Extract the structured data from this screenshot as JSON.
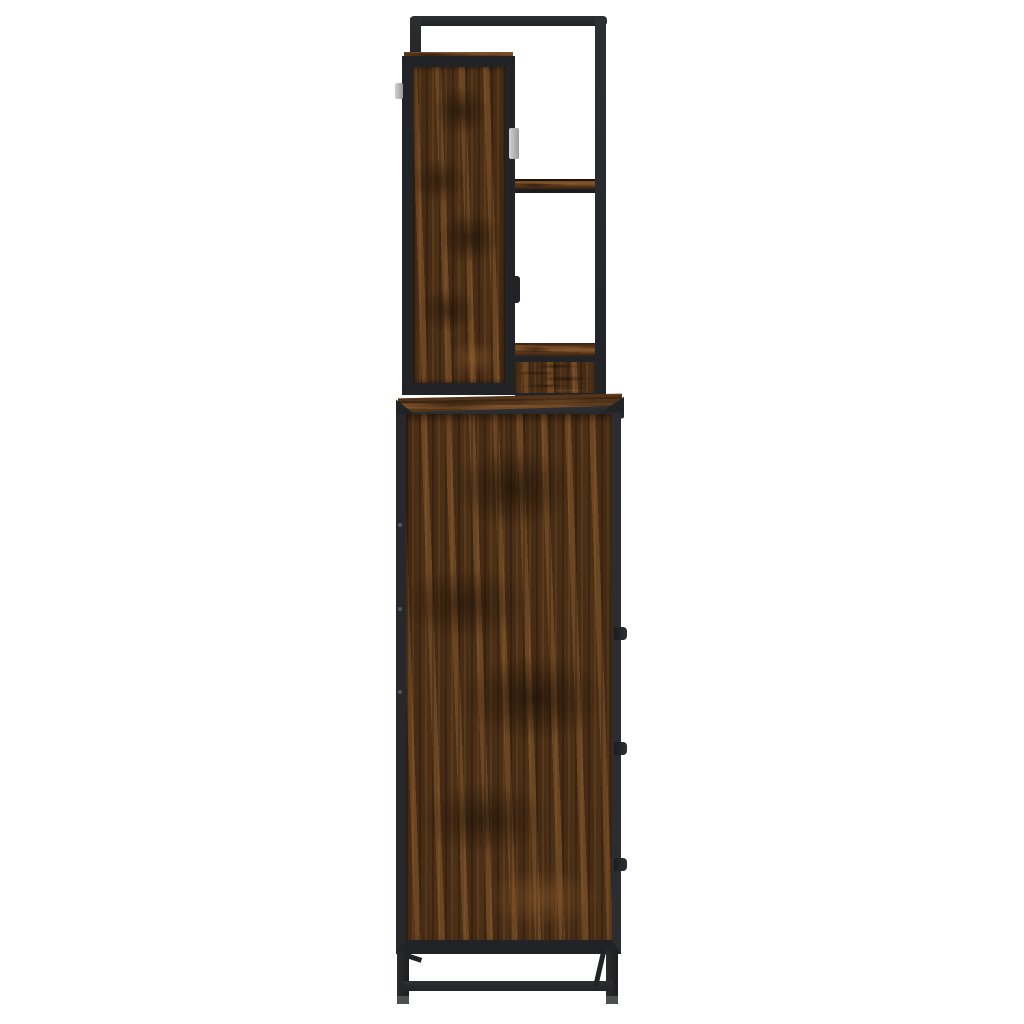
{
  "scene": {
    "type": "product-photo",
    "description": "Side view of an industrial-style tall bathroom cabinet: smoked-oak wood panels with black metal frame, a wall shelf unit with two open shelves on top, base cabinet with three drawer knobs, black metal legs with crossbar",
    "background_color": "#ffffff"
  },
  "palette": {
    "background": "#ffffff",
    "metal_frame": "#212326",
    "metal_frame_light": "#2d2f32",
    "metal_edge": "#2b2d30",
    "wood_base": "#5e3c1d",
    "wood_mid": "#6b4423",
    "wood_dark": "#2f1d0d",
    "wood_light": "#8a5a2b",
    "foot_cap": "#4e5052",
    "hinge_tab_light": "#d2d2d2",
    "hinge_tab_dark": "#9a9a9a",
    "bolt": "#55585b"
  },
  "furniture": {
    "top_unit": {
      "name": "wall shelf unit",
      "open_shelf_count": 2,
      "hinge_tab_count": 2,
      "knob_count": 1
    },
    "base_cabinet": {
      "name": "bathroom base cabinet",
      "knob_count": 3,
      "leg_count": 2,
      "bolt_count": 3
    }
  }
}
